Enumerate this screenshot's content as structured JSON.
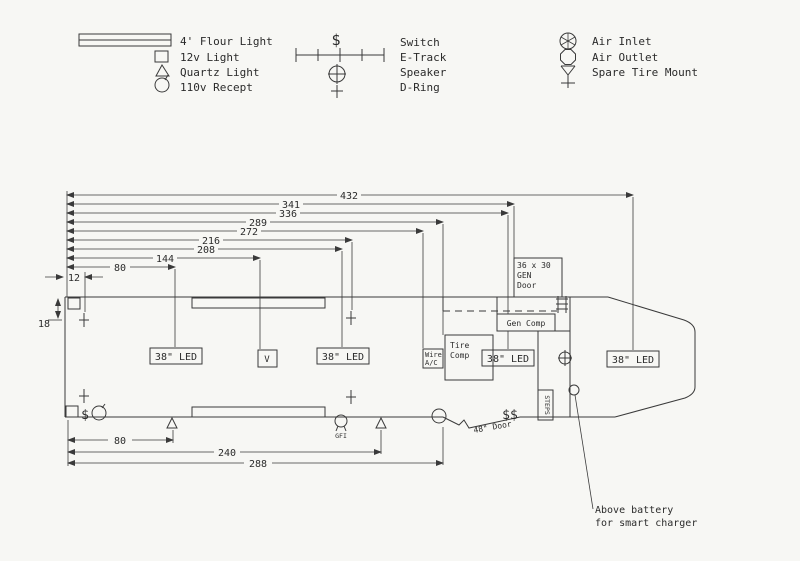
{
  "legend": {
    "left": [
      {
        "label": "4' Flour Light"
      },
      {
        "label": "12v Light"
      },
      {
        "label": "Quartz Light"
      },
      {
        "label": "110v Recept"
      }
    ],
    "middle": [
      {
        "label": "Switch"
      },
      {
        "label": "E-Track"
      },
      {
        "label": "Speaker"
      },
      {
        "label": "D-Ring"
      }
    ],
    "right": [
      {
        "label": "Air Inlet"
      },
      {
        "label": "Air Outlet"
      },
      {
        "label": "Spare Tire Mount"
      }
    ]
  },
  "symbols": {
    "switch_glyph": "$",
    "double_switch_glyph": "$$"
  },
  "dims": {
    "top": [
      "432",
      "341",
      "336",
      "289",
      "272",
      "216",
      "208",
      "144",
      "80",
      "12"
    ],
    "left": "18",
    "bottom": [
      "80",
      "240",
      "288"
    ]
  },
  "plan": {
    "led_label": "38\" LED",
    "v_label": "V",
    "wire_ac": [
      "Wire",
      "A/C"
    ],
    "tire_comp": [
      "Tire",
      "Comp"
    ],
    "gen_door": [
      "36 x 30",
      "GEN",
      "Door"
    ],
    "gen_comp": "Gen Comp",
    "steps": "STEPS",
    "door_label": "48\" Door",
    "gfi": "GFI",
    "note": [
      "Above battery",
      "for smart charger"
    ]
  }
}
